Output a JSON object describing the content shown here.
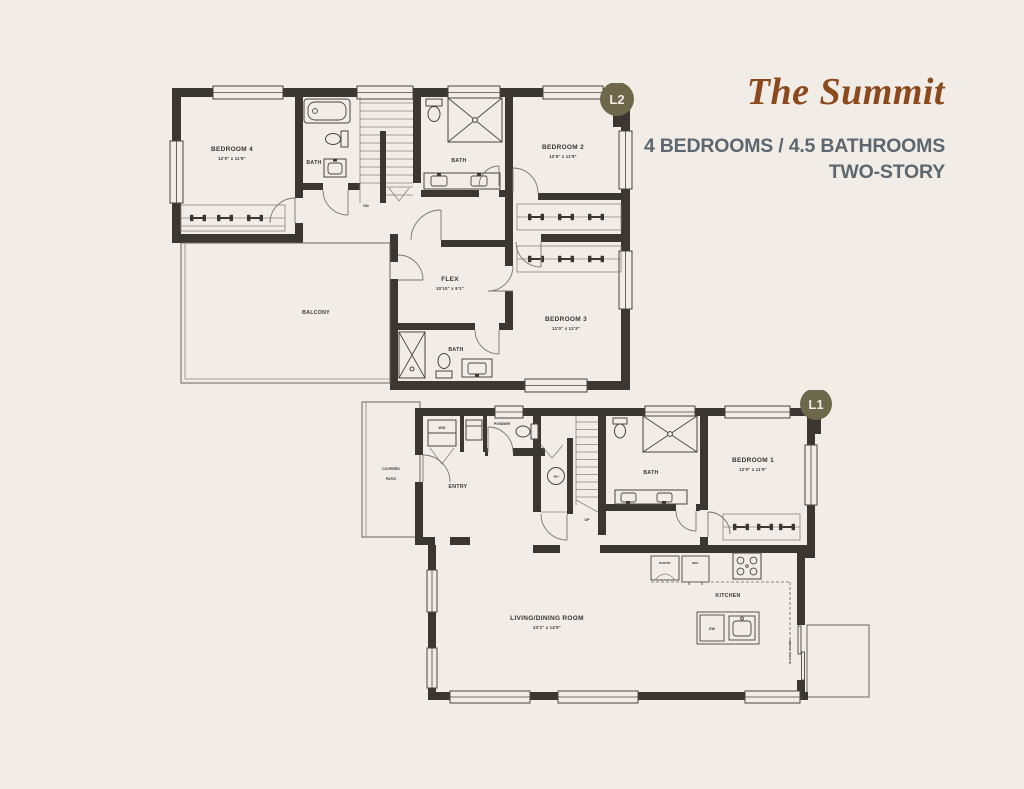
{
  "header": {
    "title": "The Summit",
    "subtitle_line1": "4 BEDROOMS / 4.5 BATHROOMS",
    "subtitle_line2": "TWO-STORY"
  },
  "colors": {
    "background": "#f2ece6",
    "wall": "#3a3632",
    "title": "#8a4a1e",
    "subtitle": "#5d6770",
    "badge": "#6d684a",
    "badge_text": "#f1ebe4"
  },
  "level2": {
    "badge": "L2",
    "bedroom4_name": "BEDROOM 4",
    "bedroom4_dims": "12'0\" x 11'9\"",
    "bedroom2_name": "BEDROOM 2",
    "bedroom2_dims": "12'6\" x 11'9\"",
    "bedroom3_name": "BEDROOM 3",
    "bedroom3_dims": "12'0\" x 12'3\"",
    "flex_name": "FLEX",
    "flex_dims": "10'10\" x 9'1\"",
    "bath_left": "BATH",
    "bath_top": "BATH",
    "bath_bottom": "BATH",
    "balcony": "BALCONY",
    "stairs": "DN"
  },
  "level1": {
    "badge": "L1",
    "covered_patio_line1": "COVERED",
    "covered_patio_line2": "PATIO",
    "entry": "ENTRY",
    "powder": "POWDER",
    "washer_dryer": "W/D",
    "water_heater": "WH",
    "bath": "BATH",
    "bedroom1_name": "BEDROOM 1",
    "bedroom1_dims": "12'0\" x 11'9\"",
    "living_name": "LIVING/DINING ROOM",
    "living_dims": "23'2\" x 14'9\"",
    "kitchen": "KITCHEN",
    "pantry": "PANTRY",
    "fridge": "REF.",
    "dishwasher": "DW",
    "sliding_doors": "SLIDING DOORS",
    "stairs": "UP"
  }
}
